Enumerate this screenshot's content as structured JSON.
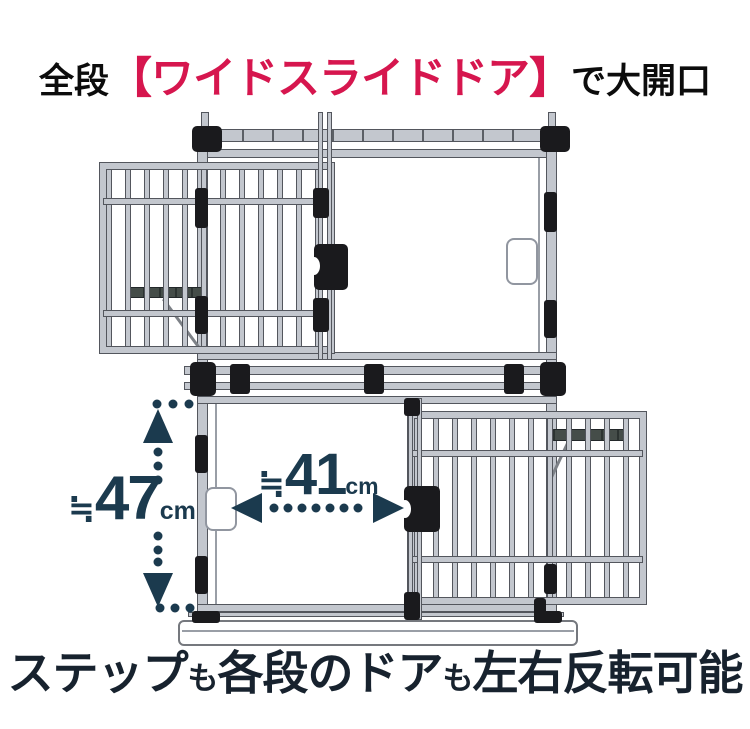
{
  "colors": {
    "red": "#d6164e",
    "navy": "#17222e",
    "dim": "#1b3a4e",
    "frame": "#c3c7ce",
    "frame-edge": "#53565d",
    "black-part": "#1a1a1d"
  },
  "header": {
    "prefix": "全段",
    "highlight": "【ワイドスライドドア】",
    "suffix": "で大開口"
  },
  "footer": {
    "segments": [
      {
        "text": "ステップ",
        "emphasis": "large"
      },
      {
        "text": "も",
        "emphasis": "small"
      },
      {
        "text": "各段のドア",
        "emphasis": "large"
      },
      {
        "text": "も",
        "emphasis": "small"
      },
      {
        "text": "左右反転可能",
        "emphasis": "large"
      }
    ]
  },
  "measurements": {
    "height": {
      "approx": "≒",
      "value": "47",
      "unit": "cm"
    },
    "width": {
      "approx": "≒",
      "value": "41",
      "unit": "cm"
    }
  },
  "illustration": {
    "subject": "2-tier pet cage, all tiers wide sliding doors, upper door slid left, lower door slid right"
  }
}
